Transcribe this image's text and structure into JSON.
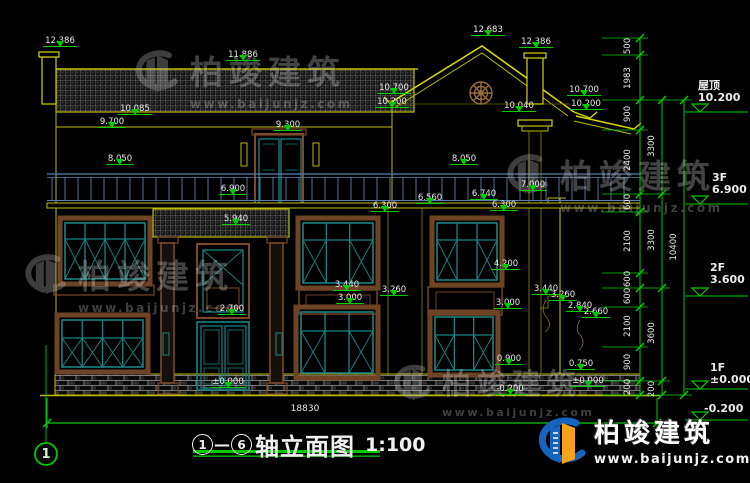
{
  "title_block": {
    "axis_start": "1",
    "axis_end": "6",
    "dash": "—",
    "name": "轴立面图",
    "scale": "1:100"
  },
  "axis_bubble": "1",
  "bottom_total_dim": "18830",
  "elevation_markers": [
    {
      "v": "12.386",
      "x": 60,
      "y": 36
    },
    {
      "v": "11.886",
      "x": 243,
      "y": 50
    },
    {
      "v": "12.683",
      "x": 488,
      "y": 25
    },
    {
      "v": "12.386",
      "x": 536,
      "y": 37
    },
    {
      "v": "10.700",
      "x": 394,
      "y": 83
    },
    {
      "v": "10.200",
      "x": 392,
      "y": 97
    },
    {
      "v": "10.700",
      "x": 584,
      "y": 85
    },
    {
      "v": "10.200",
      "x": 586,
      "y": 99
    },
    {
      "v": "10.040",
      "x": 519,
      "y": 101
    },
    {
      "v": "10.085",
      "x": 135,
      "y": 104
    },
    {
      "v": "9.700",
      "x": 112,
      "y": 117
    },
    {
      "v": "9.300",
      "x": 288,
      "y": 120
    },
    {
      "v": "8.050",
      "x": 120,
      "y": 154
    },
    {
      "v": "8.050",
      "x": 464,
      "y": 154
    },
    {
      "v": "6.900",
      "x": 233,
      "y": 184
    },
    {
      "v": "5.940",
      "x": 236,
      "y": 214
    },
    {
      "v": "6.560",
      "x": 430,
      "y": 193
    },
    {
      "v": "6.740",
      "x": 484,
      "y": 189
    },
    {
      "v": "7.000",
      "x": 533,
      "y": 180
    },
    {
      "v": "6.300",
      "x": 385,
      "y": 201
    },
    {
      "v": "6.300",
      "x": 504,
      "y": 200
    },
    {
      "v": "4.200",
      "x": 506,
      "y": 259
    },
    {
      "v": "3.440",
      "x": 347,
      "y": 280
    },
    {
      "v": "3.000",
      "x": 350,
      "y": 293
    },
    {
      "v": "3.260",
      "x": 394,
      "y": 285
    },
    {
      "v": "3.440",
      "x": 546,
      "y": 284
    },
    {
      "v": "3.260",
      "x": 563,
      "y": 290
    },
    {
      "v": "2.840",
      "x": 580,
      "y": 301
    },
    {
      "v": "2.660",
      "x": 596,
      "y": 307
    },
    {
      "v": "3.000",
      "x": 508,
      "y": 298
    },
    {
      "v": "2.700",
      "x": 232,
      "y": 304
    },
    {
      "v": "0.900",
      "x": 509,
      "y": 354
    },
    {
      "v": "0.750",
      "x": 581,
      "y": 359
    },
    {
      "v": "±0.000",
      "x": 228,
      "y": 377
    },
    {
      "v": "-0.200",
      "x": 510,
      "y": 384
    },
    {
      "v": "±0.000",
      "x": 588,
      "y": 376
    }
  ],
  "right_dim_columns": [
    {
      "x": 628,
      "items": [
        {
          "v": "500",
          "y": 46
        },
        {
          "v": "1983",
          "y": 78
        },
        {
          "v": "900",
          "y": 114
        },
        {
          "v": "2400",
          "y": 160
        },
        {
          "v": "600",
          "y": 202
        },
        {
          "v": "2100",
          "y": 241
        },
        {
          "v": "600",
          "y": 279
        },
        {
          "v": "600",
          "y": 296
        },
        {
          "v": "2100",
          "y": 326
        },
        {
          "v": "900",
          "y": 362
        },
        {
          "v": "200",
          "y": 387
        }
      ]
    },
    {
      "x": 652,
      "items": [
        {
          "v": "3300",
          "y": 146
        },
        {
          "v": "3300",
          "y": 240
        },
        {
          "v": "3600",
          "y": 333
        },
        {
          "v": "200",
          "y": 389
        }
      ]
    },
    {
      "x": 674,
      "items": [
        {
          "v": "10400",
          "y": 247
        }
      ]
    }
  ],
  "floor_levels": [
    {
      "name": "屋顶",
      "v": "10.200",
      "x": 698,
      "y": 80,
      "ly": 112
    },
    {
      "name": "3F",
      "v": "6.900",
      "x": 712,
      "y": 172,
      "ly": 204
    },
    {
      "name": "2F",
      "v": "3.600",
      "x": 710,
      "y": 262,
      "ly": 296
    },
    {
      "name": "1F",
      "v": "±0.000",
      "x": 710,
      "y": 362,
      "ly": 389
    },
    {
      "name": "",
      "v": "-0.200",
      "x": 704,
      "y": 403,
      "ly": 420
    }
  ],
  "watermark_text": {
    "title": "柏竣建筑",
    "url": "www.baijunjz.com"
  },
  "watermarks": [
    {
      "x": 126,
      "y": 46,
      "logo": 56,
      "ts": 33,
      "us": 12
    },
    {
      "x": 16,
      "y": 250,
      "logo": 54,
      "ts": 33,
      "us": 12
    },
    {
      "x": 498,
      "y": 150,
      "logo": 54,
      "ts": 33,
      "us": 12
    },
    {
      "x": 386,
      "y": 361,
      "logo": 48,
      "ts": 29,
      "us": 11
    }
  ],
  "brand_logo": {
    "title": "柏竣建筑",
    "url": "www.baijunjz.com"
  },
  "colors": {
    "background": "#000000",
    "line_yellow": "#bcbc00",
    "line_yellow_bright": "#d6d600",
    "dim_green": "#00cc00",
    "frame_teal": "#1b8383",
    "trim_brown": "#7c4a2a",
    "ornament_tan": "#9b6c3e",
    "railing_blue": "#5b7fae",
    "text_white": "#e9e9e9"
  }
}
